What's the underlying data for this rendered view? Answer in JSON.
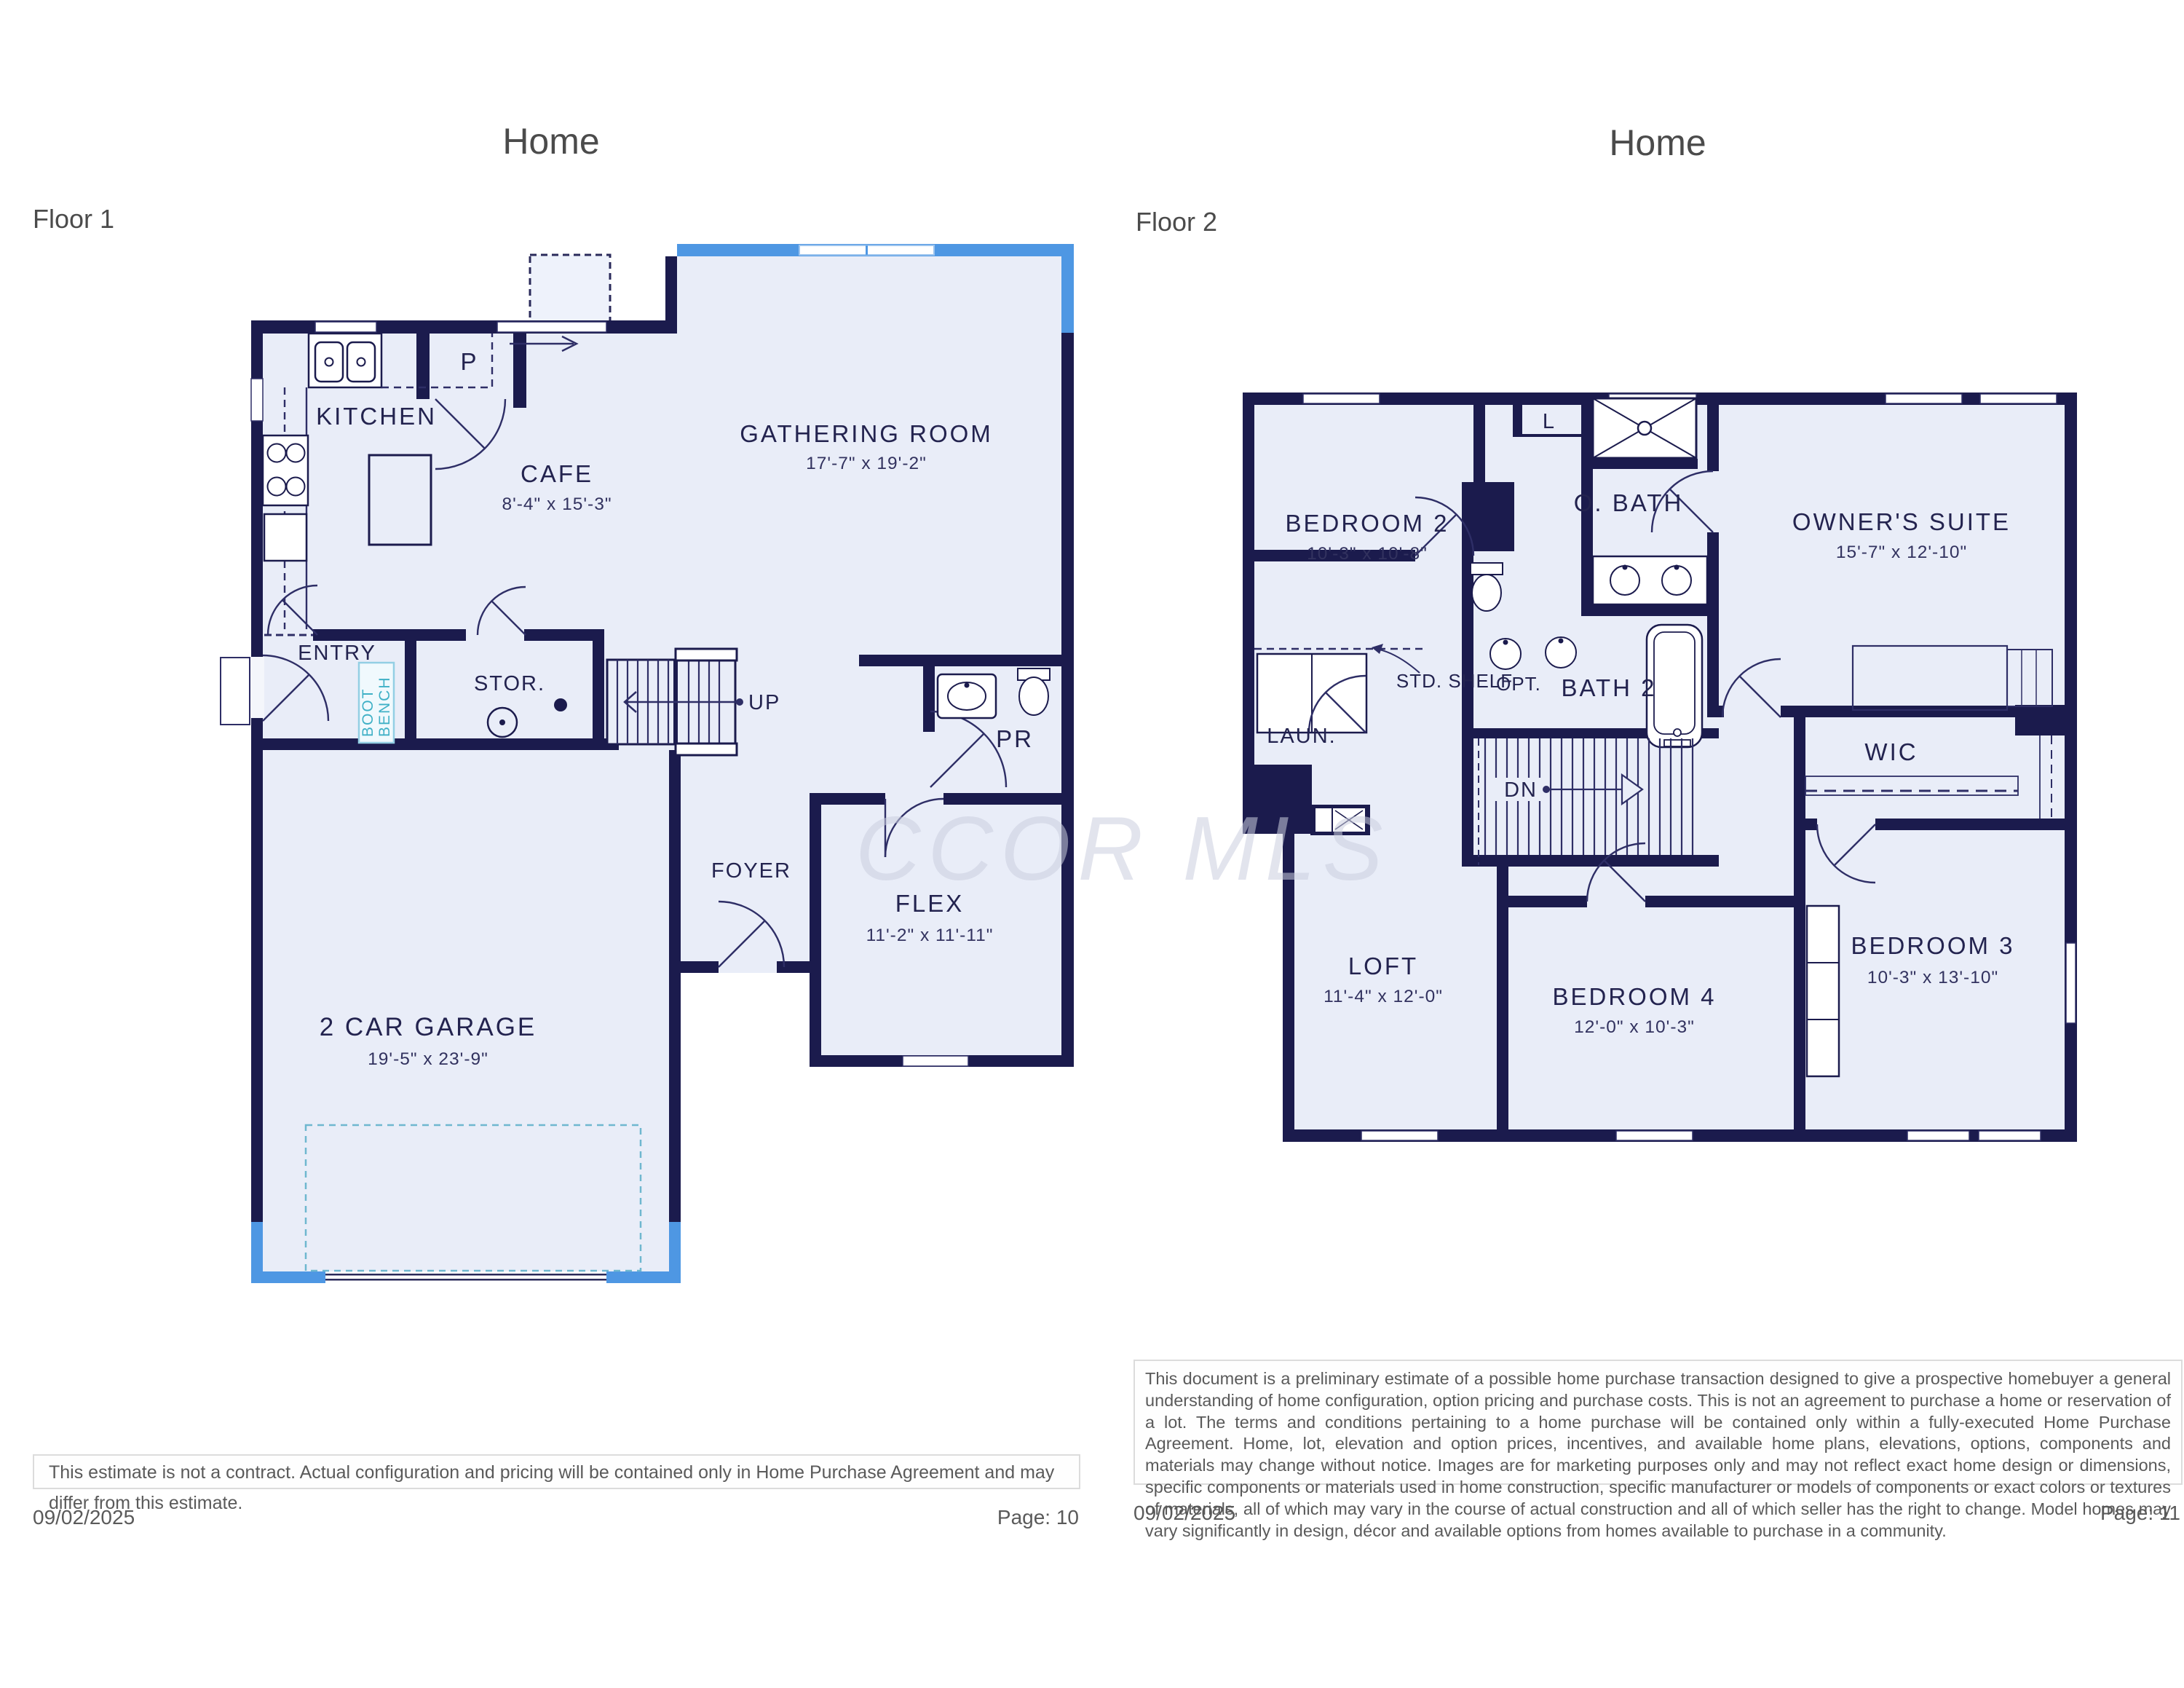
{
  "watermark": {
    "text": "CCOR MLS"
  },
  "colors": {
    "wall_navy": "#1b1b4d",
    "floor_fill": "#e9edf8",
    "accent_blue": "#4e97e3",
    "teal": "#3fb0c6",
    "label_navy": "#23234f",
    "footer_gray": "#5a5a5a"
  },
  "left": {
    "title": "Home",
    "floor_label": "Floor 1",
    "rooms": {
      "kitchen": {
        "name": "KITCHEN"
      },
      "pantry": {
        "name": "P"
      },
      "cafe": {
        "name": "CAFE",
        "dims": "8'-4\" x 15'-3\""
      },
      "gathering": {
        "name": "GATHERING ROOM",
        "dims": "17'-7\" x 19'-2\""
      },
      "entry": {
        "name": "ENTRY"
      },
      "boot_bench": {
        "line1": "BOOT",
        "line2": "BENCH"
      },
      "storage": {
        "name": "STOR."
      },
      "stairs_up": {
        "label": "UP"
      },
      "foyer": {
        "name": "FOYER"
      },
      "powder": {
        "name": "PR"
      },
      "flex": {
        "name": "FLEX",
        "dims": "11'-2\" x 11'-11\""
      },
      "garage": {
        "name": "2 CAR GARAGE",
        "dims": "19'-5\" x 23'-9\""
      }
    },
    "footer": {
      "disclaimer": "This estimate is not a contract. Actual configuration and pricing will be contained only in Home Purchase Agreement and may differ from this estimate.",
      "date": "09/02/2025",
      "page": "Page: 10"
    }
  },
  "right": {
    "title": "Home",
    "floor_label": "Floor 2",
    "rooms": {
      "bedroom2": {
        "name": "BEDROOM 2",
        "dims": "10'-3\" x 10'-8\""
      },
      "linen": {
        "name": "L"
      },
      "owners_bath": {
        "name": "O. BATH"
      },
      "owners_suite": {
        "name": "OWNER'S SUITE",
        "dims": "15'-7\" x 12'-10\""
      },
      "laundry": {
        "name": "LAUN."
      },
      "std_shelf": {
        "name": "STD. SHELF"
      },
      "opt": {
        "name": "OPT."
      },
      "bath2": {
        "name": "BATH 2"
      },
      "stairs_down": {
        "label": "DN"
      },
      "wic": {
        "name": "WIC"
      },
      "loft": {
        "name": "LOFT",
        "dims": "11'-4\" x 12'-0\""
      },
      "bedroom4": {
        "name": "BEDROOM 4",
        "dims": "12'-0\" x 10'-3\""
      },
      "bedroom3": {
        "name": "BEDROOM 3",
        "dims": "10'-3\" x 13'-10\""
      }
    },
    "footer": {
      "disclaimer": "This document is a preliminary estimate of a possible home purchase transaction designed to give a prospective homebuyer a general understanding of home configuration, option pricing and purchase costs. This is not an agreement to purchase a home or reservation of a lot. The terms and conditions pertaining to a home purchase will be contained only within a fully-executed Home Purchase Agreement. Home, lot, elevation and option prices, incentives, and available home plans, elevations, options, components and materials may change without notice. Images are for marketing purposes only and may not reflect exact home design or dimensions, specific components or materials used in home construction, specific manufacturer or models of components or exact colors or textures of materials, all of which may vary in the course of actual construction and all of which seller has the right to change. Model homes may vary significantly in design, décor and available options from homes available to purchase in a community.",
      "date": "09/02/2025",
      "page": "Page: 11"
    }
  }
}
